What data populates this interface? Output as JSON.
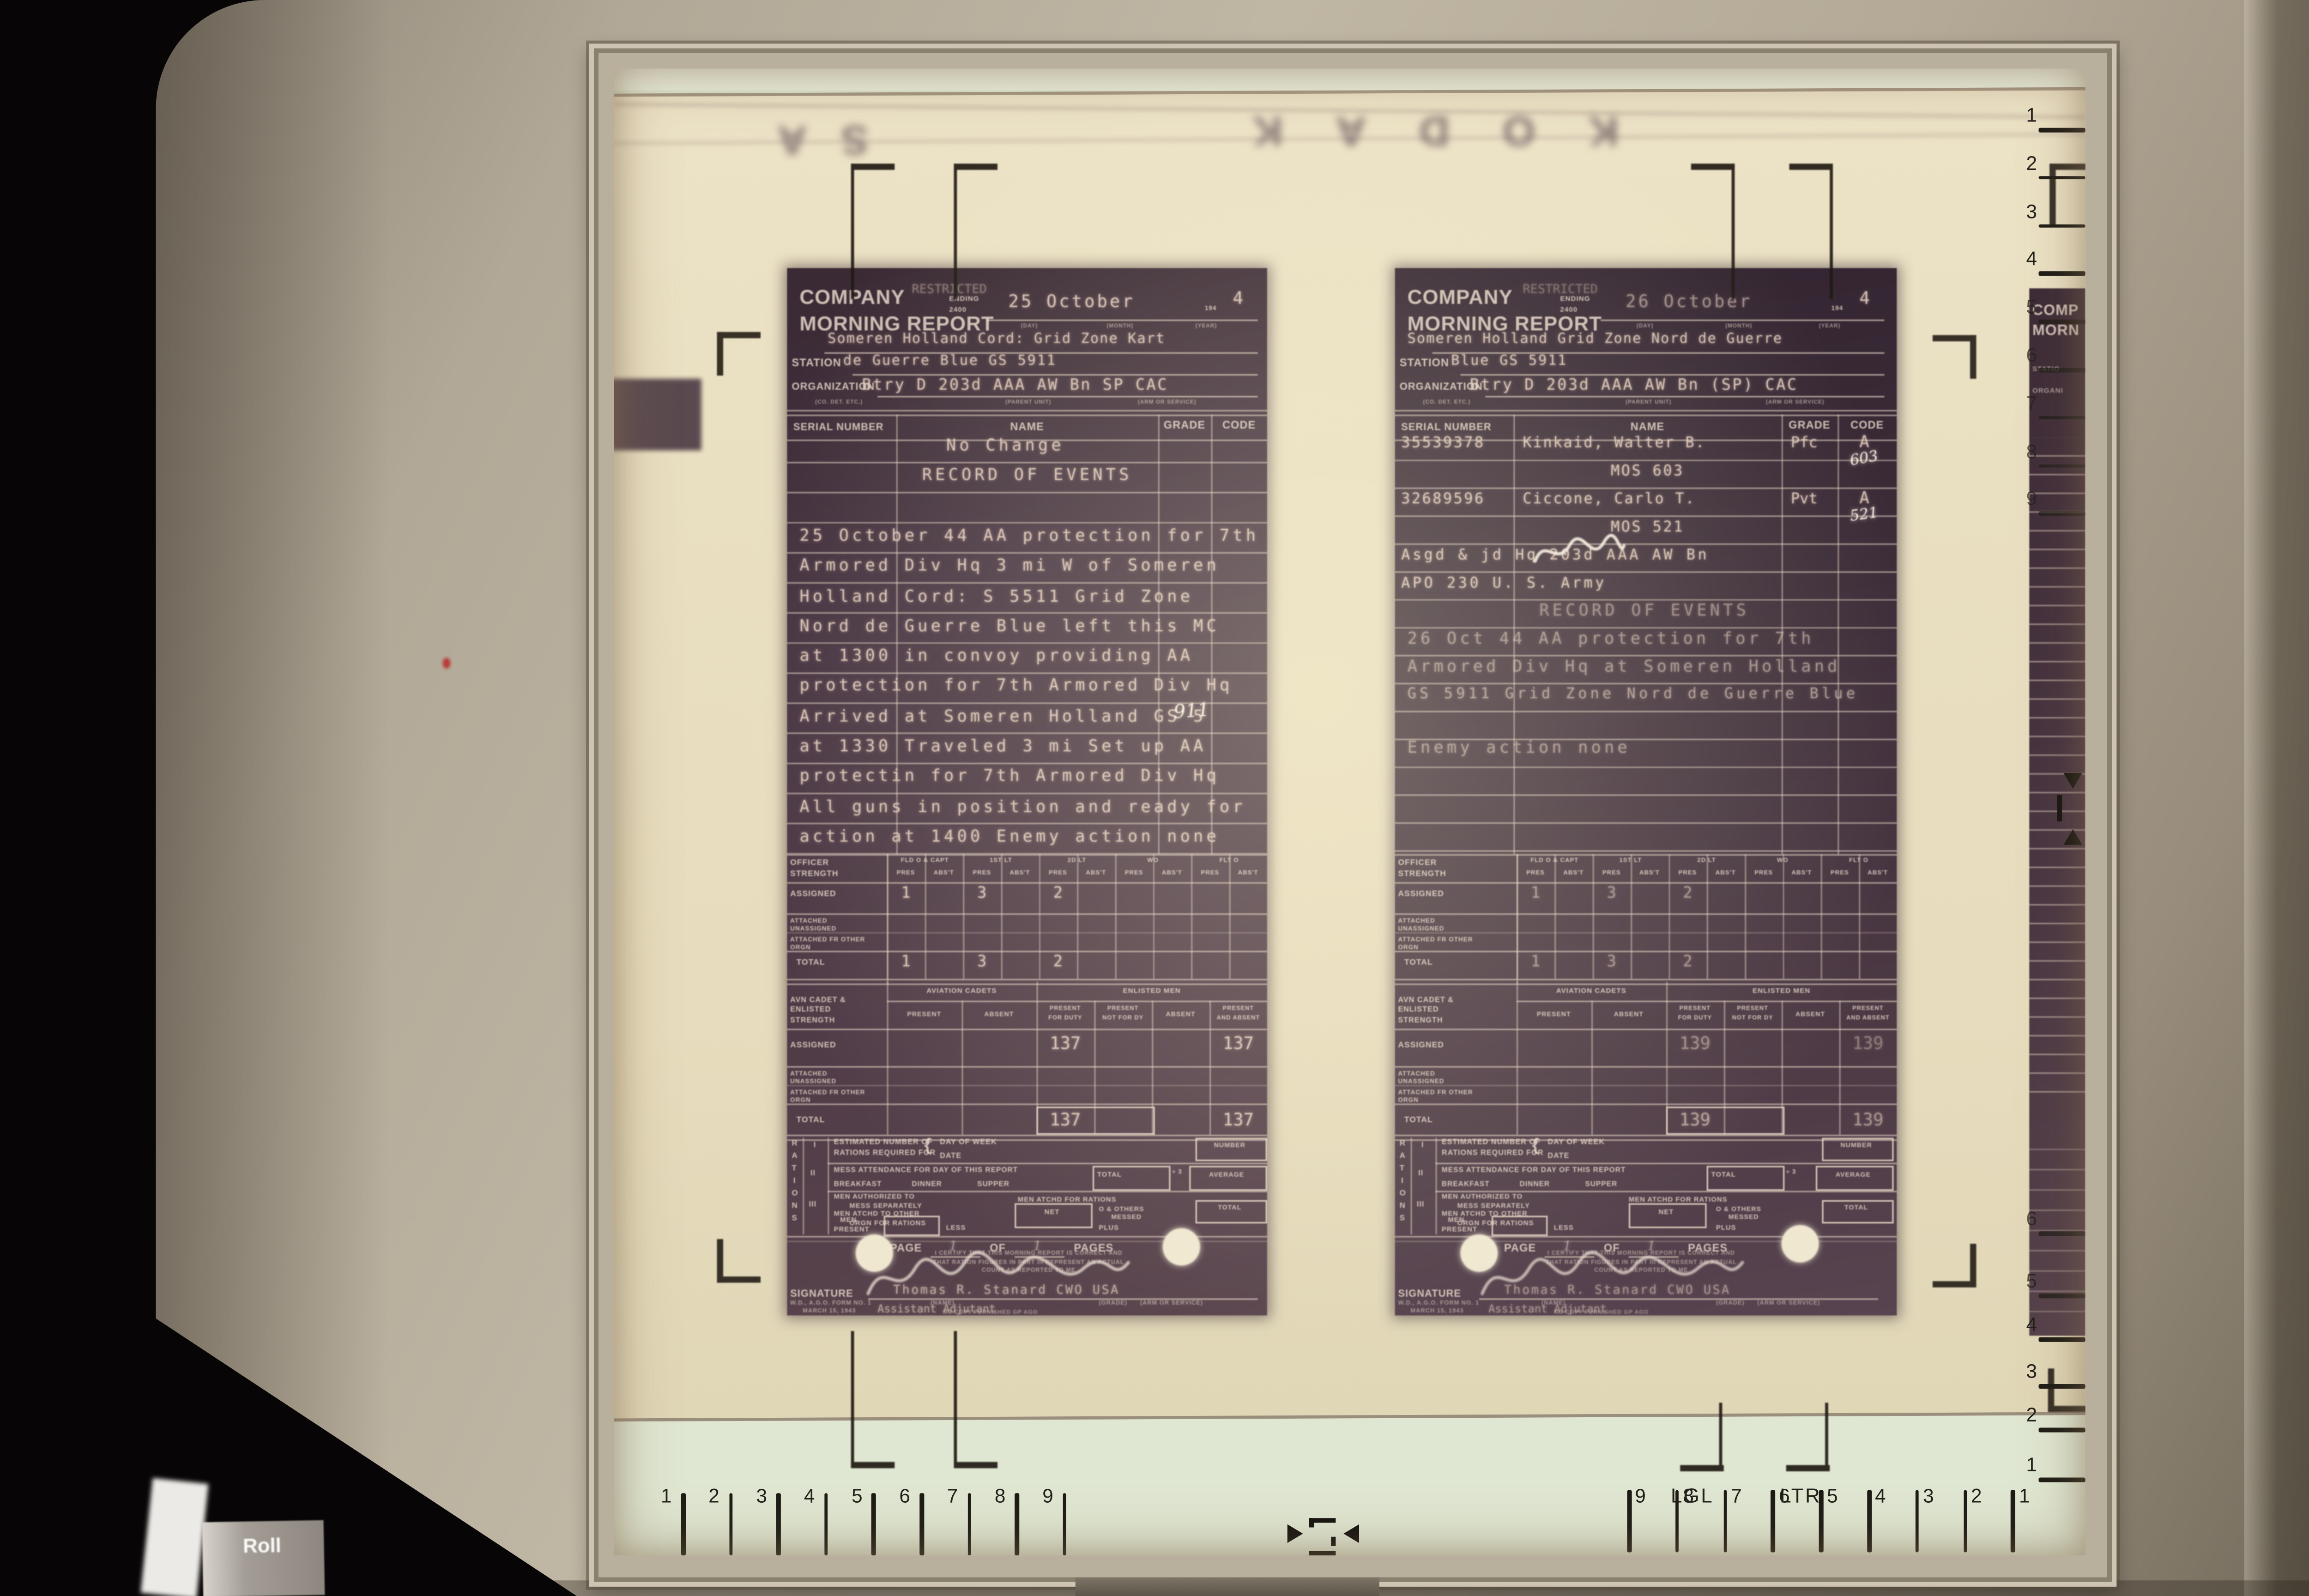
{
  "machine": {
    "roll_label": "Roll"
  },
  "screen": {
    "film_edge_left": "SA",
    "film_edge_brand": "KODAK",
    "guide_lgl": "LGL",
    "guide_ltr": "LTR",
    "ruler_bottom_left": [
      "1",
      "2",
      "3",
      "4",
      "5",
      "6",
      "7",
      "8",
      "9"
    ],
    "ruler_bottom_right": [
      "9",
      "8",
      "7",
      "6",
      "5",
      "4",
      "3",
      "2",
      "1"
    ],
    "ruler_right_top": [
      "1",
      "2",
      "3",
      "4",
      "5",
      "6",
      "7",
      "8",
      "9"
    ],
    "ruler_right_bottom": [
      "6",
      "5",
      "4",
      "3",
      "2",
      "1"
    ]
  },
  "form": {
    "title1": "COMPANY",
    "title2": "MORNING REPORT",
    "restricted": "RESTRICTED",
    "ending": "ENDING",
    "hour": "2400",
    "cap_day": "(DAY)",
    "cap_month": "(MONTH)",
    "cap_year": "(YEAR)",
    "year_prefix": "194",
    "station": "STATION",
    "organization": "ORGANIZATION",
    "cap_co": "(CO. DET. ETC.)",
    "cap_parent": "(PARENT UNIT)",
    "cap_arm": "(ARM OR SERVICE)",
    "serial": "SERIAL NUMBER",
    "name": "NAME",
    "grade": "GRADE",
    "code": "CODE",
    "officer": "OFFICER STRENGTH",
    "grp": [
      "FLD O & CAPT",
      "1ST LT",
      "2D LT",
      "WO",
      "FLT O"
    ],
    "pres": "PRES",
    "abst": "ABS'T",
    "assigned": "ASSIGNED",
    "att_un": "ATTACHED UNASSIGNED",
    "att_fr": "ATTACHED FR OTHER ORGN",
    "total": "TOTAL",
    "avn": "AVN CADET & ENLISTED STRENGTH",
    "cadets": "AVIATION CADETS",
    "enlisted": "ENLISTED MEN",
    "present": "PRESENT",
    "absent": "ABSENT",
    "pfd1": "PRESENT",
    "pfd2": "FOR DUTY",
    "pnf1": "PRESENT",
    "pnf2": "NOT FOR DY",
    "paa1": "PRESENT",
    "paa2": "AND ABSENT",
    "rations_letters": [
      "R",
      "A",
      "T",
      "I",
      "O",
      "N",
      "S"
    ],
    "r1": "I",
    "r2": "II",
    "r3": "III",
    "est1": "ESTIMATED NUMBER OF",
    "est2": "RATIONS REQUIRED FOR",
    "brace": "{",
    "dow": "DAY OF WEEK",
    "date": "DATE",
    "number": "NUMBER",
    "mess": "MESS ATTENDANCE FOR DAY OF THIS REPORT",
    "div3": "÷ 3",
    "average": "AVERAGE",
    "breakfast": "BREAKFAST",
    "dinner": "DINNER",
    "supper": "SUPPER",
    "auth1": "MEN AUTHORIZED TO",
    "auth2": "MESS SEPARATELY",
    "atchd": "MEN ATCHD FOR RATIONS",
    "other1": "MEN ATCHD TO OTHER",
    "other2": "ORGN FOR RATIONS",
    "net": "NET",
    "oth_messed1": "O & OTHERS",
    "oth_messed2": "MESSED",
    "men": "MEN",
    "present_l": "PRESENT",
    "less": "LESS",
    "plus": "PLUS",
    "page": "PAGE",
    "of": "OF",
    "pages": "PAGES",
    "cert1": "I CERTIFY THAT THIS MORNING REPORT IS CORRECT AND",
    "cert2": "THAT RATION FIGURES IN PART III REPRESENT AN ACTUAL",
    "cert3": "COUNT AS REPORTED TO ME",
    "signature": "SIGNATURE",
    "form_no1": "W.D., A.G.O. FORM NO. 1",
    "form_no2": "MARCH 15, 1943",
    "cap_name": "(NAME)",
    "cap_grade_arm": "(GRADE)      (ARM OR SERVICE)"
  },
  "left_doc": {
    "date": "25 October",
    "year": "4",
    "station1": "Someren Holland Cord: Grid Zone Kart",
    "station2": "de Guerre Blue GS 5911",
    "org": "Btry D 203d AAA AW Bn SP  CAC",
    "lines": [
      "No Change",
      "RECORD OF EVENTS",
      "25 October 44 AA protection for 7th",
      "Armored Div Hq 3 mi W of Someren",
      "Holland Cord: S 5511 Grid Zone",
      "Nord de Guerre Blue  left this MC",
      "at 1300 in convoy providing AA",
      "protection for 7th Armored Div Hq",
      "Arrived at Someren Holland GS 5",
      "at 1330 Traveled 3 mi  Set up AA",
      "protectin for 7th Armored Div Hq",
      "All guns in position and ready for",
      "action at 1400  Enemy action none"
    ],
    "hand_911": "911",
    "off_assigned": [
      "1",
      "3",
      "2"
    ],
    "off_total": [
      "1",
      "3",
      "2"
    ],
    "enl_assigned_pfd": "137",
    "enl_assigned_paa": "137",
    "enl_total_pfd": "137",
    "enl_total_paa": "137",
    "page_no": "1",
    "pages_no": "1",
    "sig_name": "Thomas R. Stanard   CWO   USA",
    "sig_title": "Assistant Adjutant",
    "footer_note": "NO COPY FURNISHED GP AGO"
  },
  "right_doc": {
    "date": "26 October",
    "year": "4",
    "station1": "Someren Holland Grid Zone Nord de Guerre",
    "station2": "Blue GS 5911",
    "org": "Btry D 203d AAA AW Bn (SP) CAC",
    "roster": [
      {
        "serial": "35539378",
        "name": "Kinkaid, Walter B.",
        "grade": "Pfc",
        "code": "A",
        "hand": "603"
      },
      {
        "serial": "32689596",
        "name": "Ciccone, Carlo T.",
        "grade": "Pvt",
        "code": "A",
        "hand": "521"
      }
    ],
    "mos1": "MOS 603",
    "mos2": "MOS 521",
    "asgd": "Asgd & jd Hq 203d AAA AW Bn",
    "apo": "APO 230 U. S. Army",
    "lines": [
      "RECORD OF EVENTS",
      "26 Oct 44 AA protection for 7th",
      "Armored Div Hq at Someren Holland",
      "GS 5911 Grid Zone Nord de Guerre Blue",
      "Enemy action none"
    ],
    "off_assigned": [
      "1",
      "3",
      "2"
    ],
    "off_total": [
      "1",
      "3",
      "2"
    ],
    "enl_assigned_pfd": "139",
    "enl_assigned_paa": "139",
    "enl_total_pfd": "139",
    "enl_total_paa": "139",
    "page_no": "1",
    "pages_no": "1",
    "sig_name": "Thomas R. Stanard   CWO   USA",
    "sig_title": "Assistant Adjutant",
    "footer_note": "NO COPY FURNISHED GP AGO"
  },
  "partial_doc": {
    "t1": "COMP",
    "t2": "MORN",
    "station": "STATIO",
    "org": "ORGANI"
  }
}
